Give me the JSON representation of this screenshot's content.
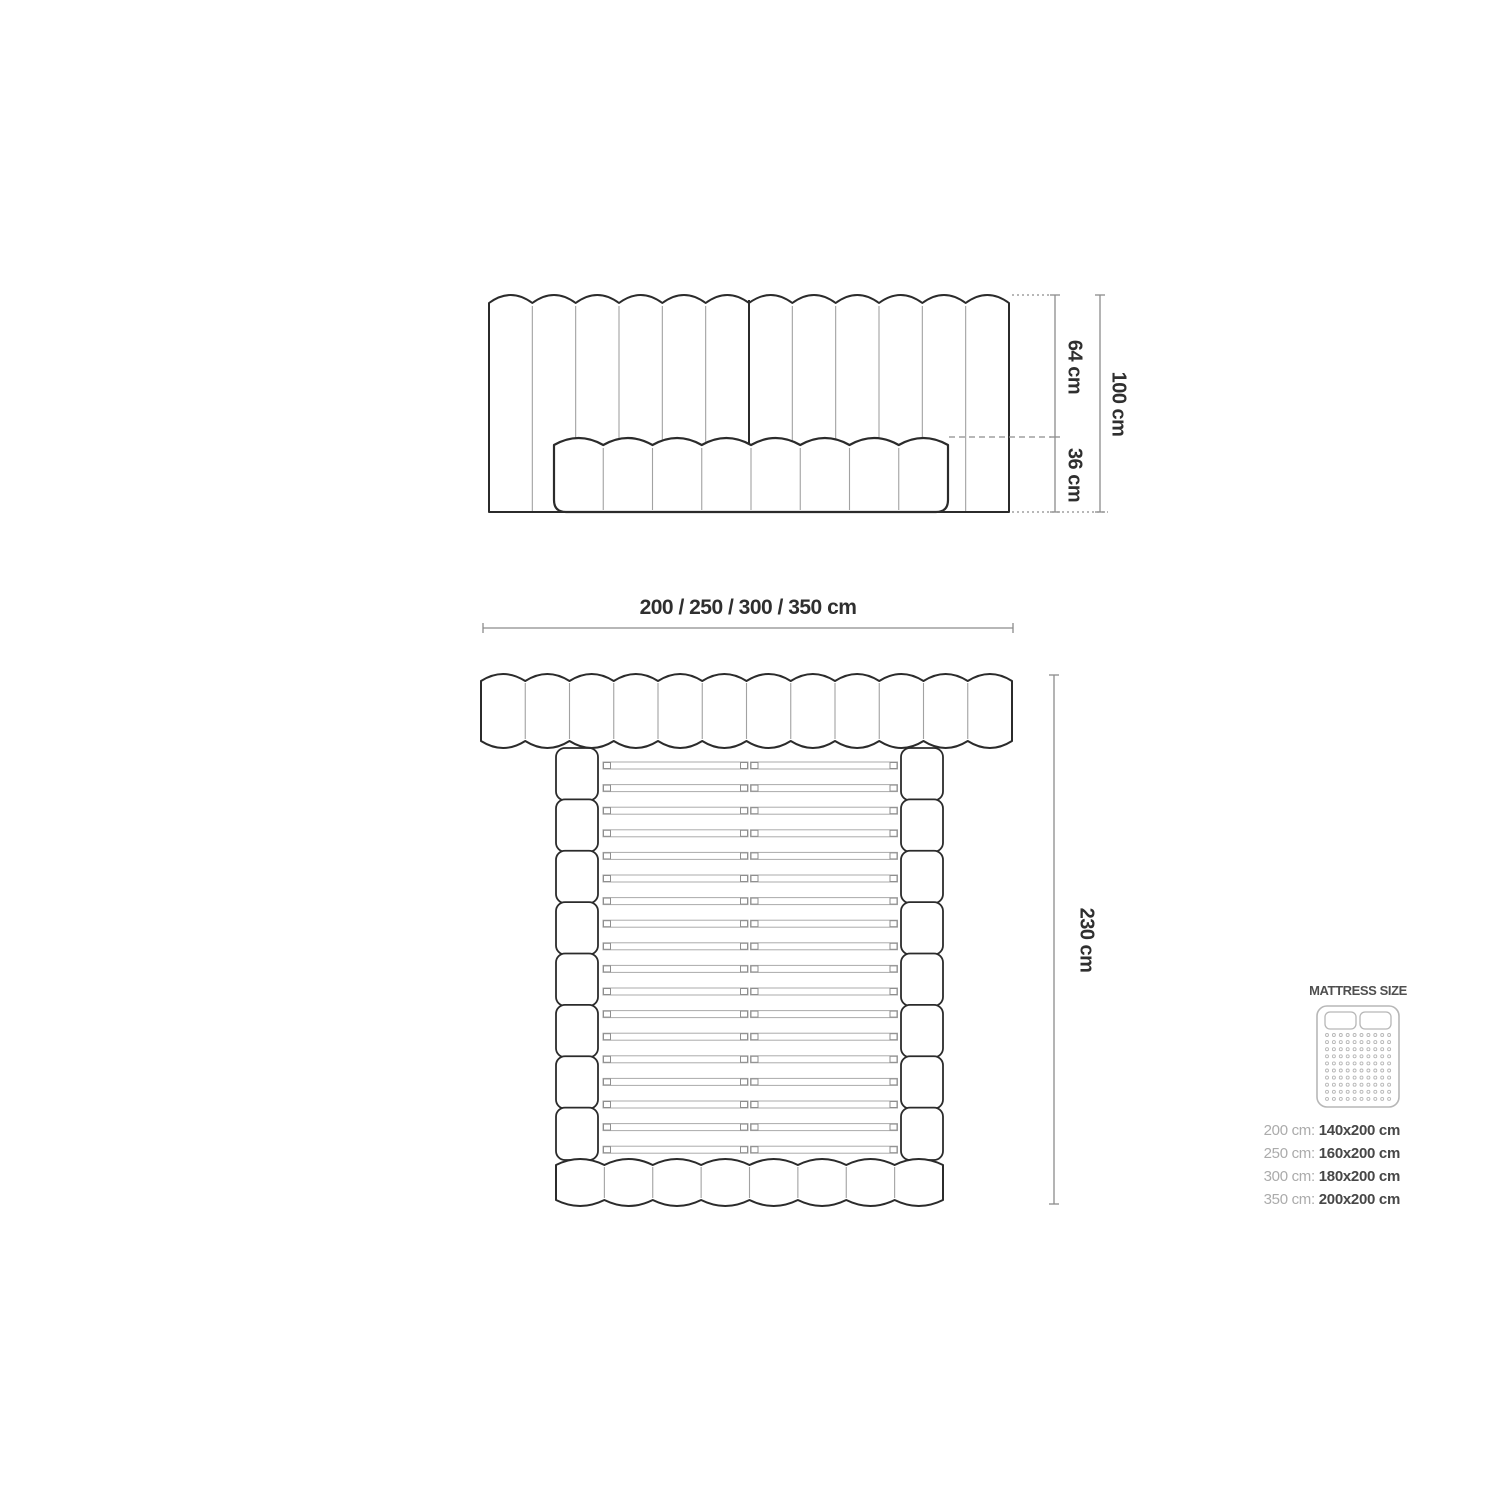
{
  "front_view": {
    "upper_height_label": "64 cm",
    "lower_height_label": "36 cm",
    "total_height_label": "100 cm"
  },
  "plan_view": {
    "width_label": "200 / 250 / 300 / 350 cm",
    "length_label": "230 cm"
  },
  "mattress_legend": {
    "title": "MATTRESS SIZE",
    "rows": [
      {
        "frame": "200 cm:",
        "mattress": "140x200 cm"
      },
      {
        "frame": "250 cm:",
        "mattress": "160x200 cm"
      },
      {
        "frame": "300 cm:",
        "mattress": "180x200 cm"
      },
      {
        "frame": "350 cm:",
        "mattress": "200x200 cm"
      }
    ]
  },
  "diagram": {
    "headboard_channels": 12,
    "front_mattress_segments": 8,
    "plan_headboard_bumps": 12,
    "rail_segments_per_side": 8,
    "footboard_bumps": 8,
    "slat_count": 18,
    "slats_split_in_center": true,
    "colors": {
      "outline_dark": "#2b2b2b",
      "line_light": "#a2a2a2",
      "dimension_gray": "#8c8c8c",
      "slat_gray": "#ababab",
      "icon_gray": "#b7b7b7",
      "text_dark": "#2f2f2f",
      "legend_label_gray": "#ababab",
      "legend_value_dark": "#474747",
      "background": "#ffffff"
    }
  }
}
